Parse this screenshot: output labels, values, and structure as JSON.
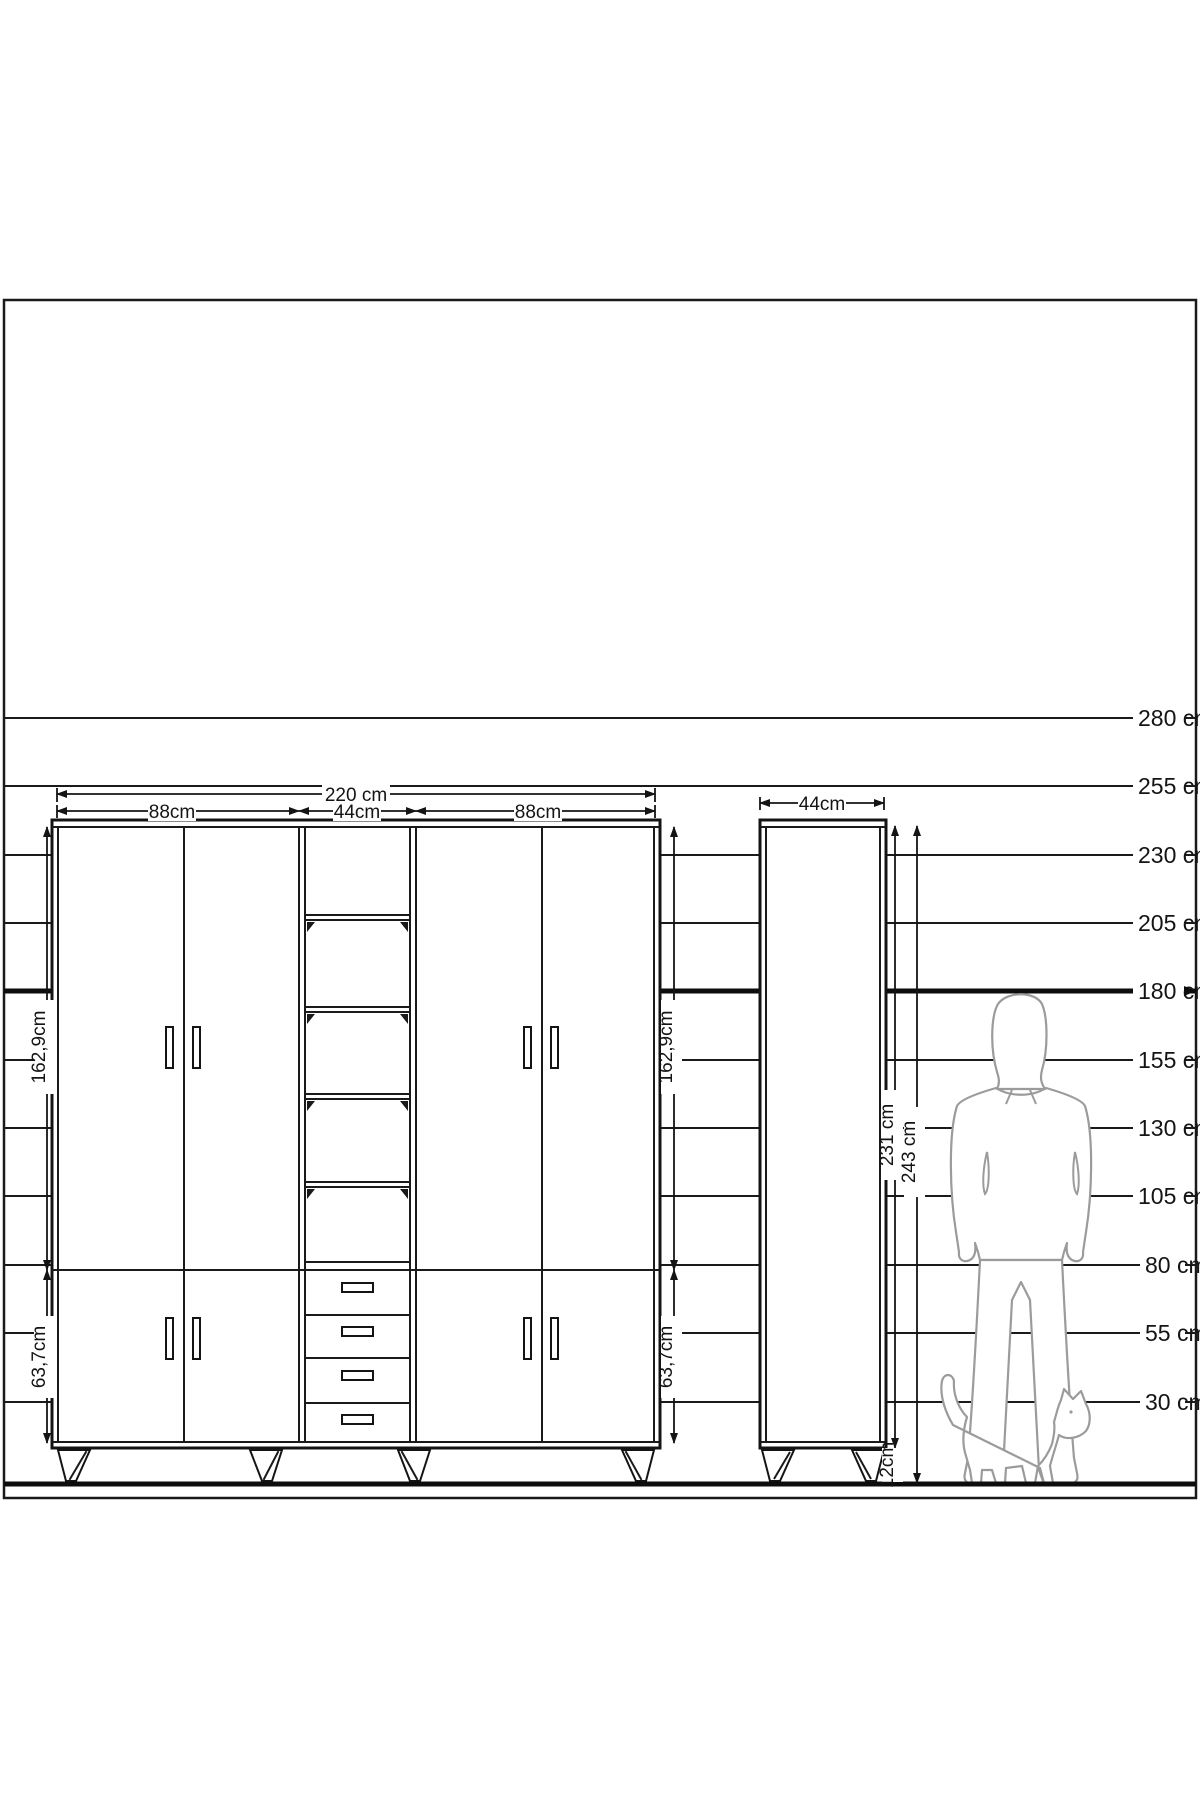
{
  "drawing": {
    "title": "wardrobe elevation with height scale",
    "scale_labels": [
      "280 cm",
      "255 cm",
      "230 cm",
      "205 cm",
      "180 cm",
      "155 cm",
      "130 cm",
      "105 cm",
      "80 cm",
      "55 cm",
      "30 cm"
    ],
    "main_cabinet": {
      "total_width": "220 cm",
      "section_widths": [
        "88cm",
        "44cm",
        "88cm"
      ],
      "upper_section_height": "162,9cm",
      "lower_section_height": "63,7cm"
    },
    "tall_cabinet": {
      "width": "44cm",
      "body_height": "231 cm",
      "total_height": "243 cm",
      "leg_height": "12cm"
    }
  }
}
